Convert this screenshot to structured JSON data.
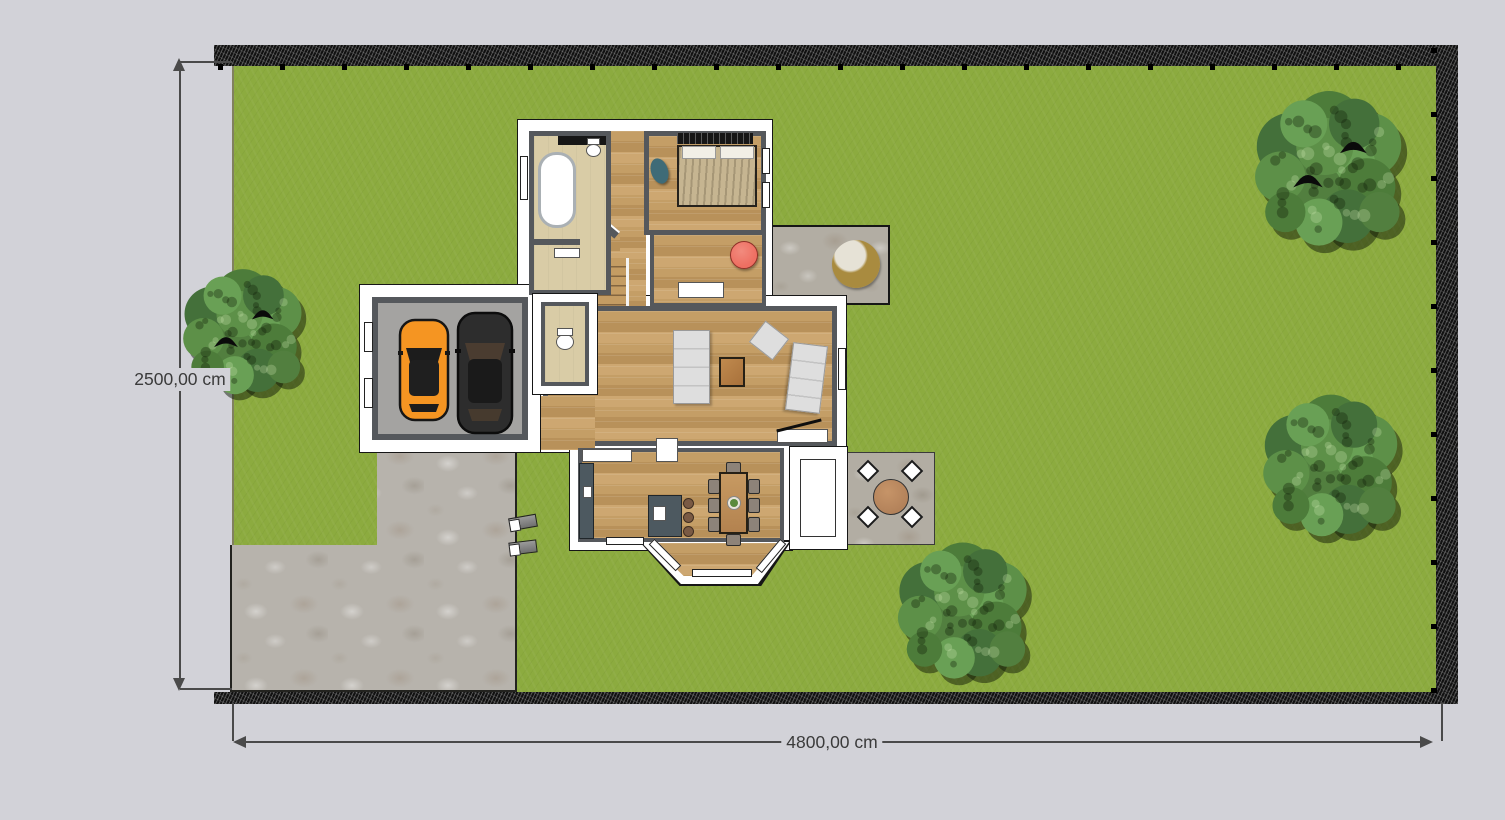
{
  "view": {
    "type": "floor-plan-top-view"
  },
  "labels": {
    "lot_height": "2500,00 cm",
    "lot_width": "4800,00 cm"
  },
  "colors": {
    "bg": "#d2d2d8",
    "grass": "#8cab3f",
    "fence": "#111111",
    "stone": "#b2ada3",
    "stone2": "#b7b3ac",
    "wood": "#c49c63",
    "wall": "#55585c",
    "floorbath": "#d9cca6",
    "garagefloor": "#a4a3a1",
    "car1": "#f59522",
    "car2": "#2d2d2d",
    "sofa": "#dedede",
    "bed": "#c6b591",
    "chairred": "#ee6f62",
    "island": "#4d5960",
    "tablewood": "#b3825a",
    "lounger": "#a98b3f",
    "dim": "#4a4a4a",
    "text": "#3b3b3b"
  },
  "trees": [
    {
      "x": 243,
      "y": 333,
      "r": 68,
      "birds": true
    },
    {
      "x": 1329,
      "y": 170,
      "r": 84,
      "birds": true
    },
    {
      "x": 1331,
      "y": 467,
      "r": 77,
      "birds": false
    },
    {
      "x": 963,
      "y": 612,
      "r": 74,
      "birds": false
    }
  ]
}
